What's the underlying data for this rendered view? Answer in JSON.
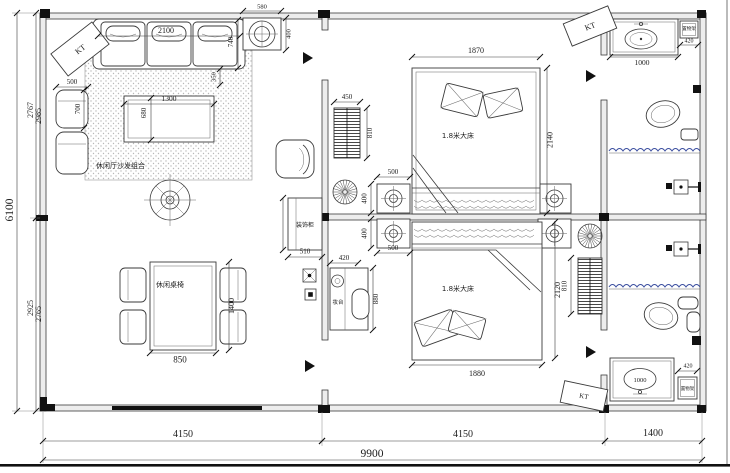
{
  "meta": {
    "drawing": "apartment-floor-plan"
  },
  "labels": {
    "sofa_area": "休闲厅沙发组合",
    "dining": "休闲桌椅",
    "cabinet": "装饰柜",
    "dresser": "妆台",
    "bed1": "1.8米大床",
    "bed2": "1.8米大床",
    "shelf1": "置物架",
    "shelf2": "置物架",
    "kt1": "KT",
    "kt2": "KT",
    "kt3": "KT"
  },
  "dims": {
    "total_w": "9900",
    "seg_living": "4150",
    "seg_bed": "4150",
    "seg_bath": "1400",
    "total_h": "6100",
    "left_top_1": "2767",
    "left_top_2": "2985",
    "left_bot_1": "2925",
    "left_bot_2": "2765",
    "sofa_w": "2100",
    "sofa_d": "740",
    "sofa_gap": "350",
    "side_w": "500",
    "side_d": "700",
    "coffee_w": "1300",
    "coffee_d": "680",
    "ceil_w": "580",
    "ceil_d": "400",
    "dining_w": "850",
    "dining_l": "1400",
    "cab_w": "510",
    "ac1_w": "450",
    "ac1_h": "810",
    "ac2_h": "810",
    "ns_top_w": "500",
    "ns_top_h": "400",
    "ns_bot_w": "500",
    "ns_bot_h": "400",
    "dresser_w": "420",
    "dresser_l": "880",
    "bed1_w": "1870",
    "bed1_l": "2140",
    "bed2_w": "1880",
    "bed2_l": "2120",
    "vanity1": "1000",
    "shelf1_w": "420",
    "vanity2": "1000",
    "shelf2_w": "420"
  },
  "colors": {
    "curtain": "#3c4fa0",
    "line": "#3a3a3a"
  }
}
